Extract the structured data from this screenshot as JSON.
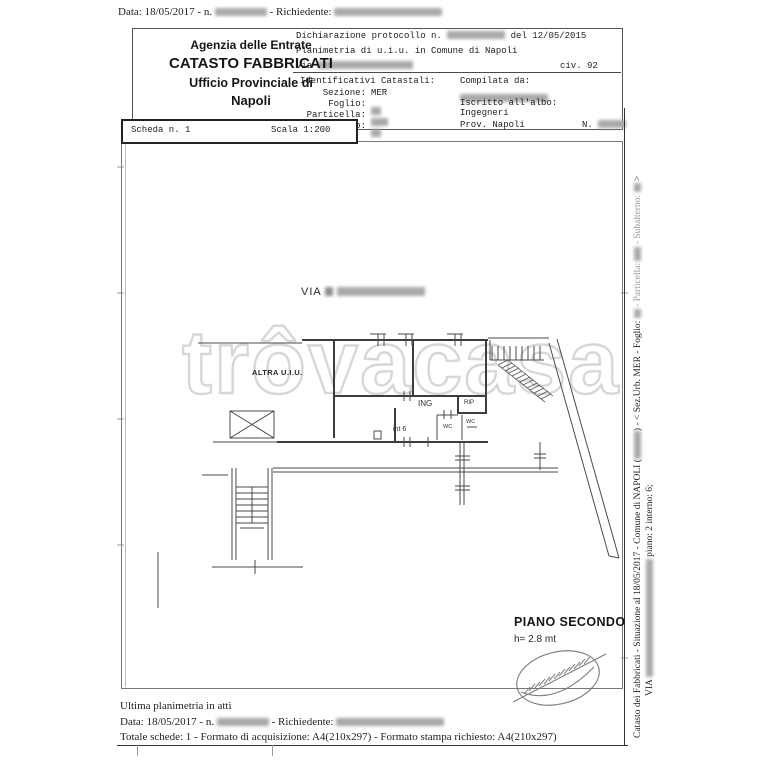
{
  "document": {
    "top_line": {
      "data_label": "Data: 18/05/2017 - n.",
      "richiedente_label": "- Richiedente:"
    },
    "header": {
      "agency_line1": "Agenzia delle Entrate",
      "agency_line2": "CATASTO FABBRICATI",
      "agency_line3": "Ufficio Provinciale di",
      "agency_line4": "Napoli",
      "declaration_pre": "Dichiarazione protocollo n.",
      "declaration_post": "del  12/05/2015",
      "planimetria": "Planimetria di u.i.u. in Comune di Napoli",
      "via_label": "Via",
      "civ": "civ. 92",
      "identificativi_title": "Identificativi Catastali:",
      "sezione_label": "Sezione:",
      "sezione_value": "MER",
      "foglio_label": "Foglio:",
      "particella_label": "Particella:",
      "subalterno_label": "Subalterno:",
      "compilata_label": "Compilata da:",
      "albo_label": "Iscritto all'albo:",
      "albo_value": "Ingegneri",
      "prov_label": "Prov. Napoli",
      "n_label": "N."
    },
    "scheda_bar": {
      "scheda": "Scheda n. 1",
      "scala": "Scala 1:200"
    },
    "plan": {
      "street": "VIA",
      "altra_uiu": "ALTRA U.I.U.",
      "ing": "ING",
      "rip": "RIP",
      "wc_a": "WC",
      "wc_b": "WC",
      "int6": "int 6",
      "piano": "PIANO SECONDO",
      "altezza": "h= 2.8 mt"
    },
    "watermark": "trôvacasa",
    "footer": {
      "ultima": "Ultima planimetria in atti",
      "data_label": "Data: 18/05/2017 - n.",
      "richiedente_label": "- Richiedente:",
      "totale": "Totale schede: 1 - Formato di acquisizione: A4(210x297)  - Formato stampa richiesto: A4(210x297)"
    },
    "side_text": {
      "l1a": "Catasto dei Fabbricati - Situazione al 18/05/2017 - Comune di NAPOLI (",
      "l1b": ") - < Sez.Urb. MER - Foglio:",
      "l1c": "- Particella:",
      "l1d": "- Subalterno:",
      "l1e": ">",
      "l2a": "VIA",
      "l2b": "piano: 2 interno: 6;"
    }
  }
}
